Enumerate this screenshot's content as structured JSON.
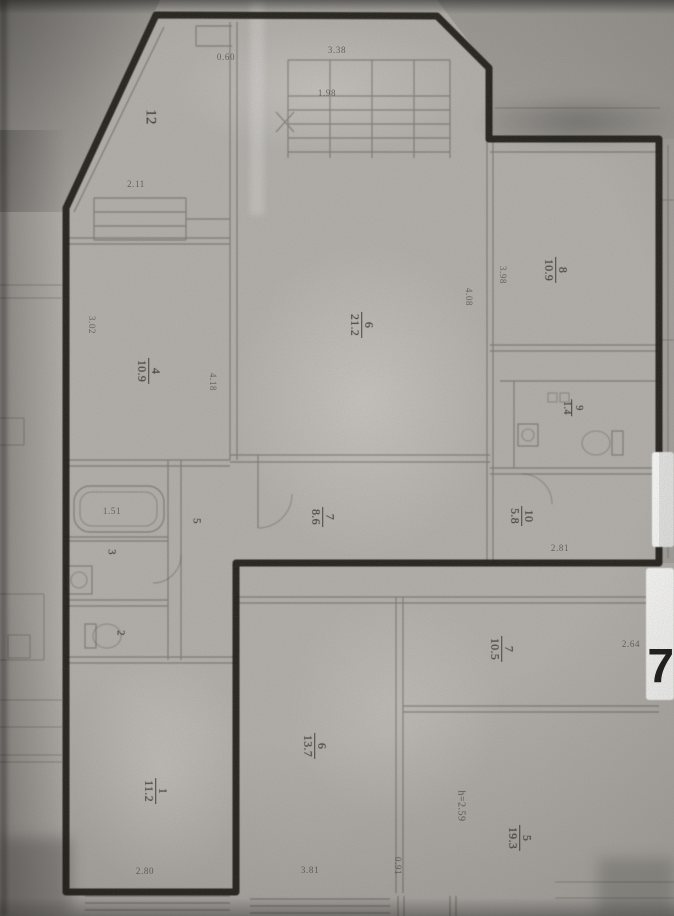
{
  "room_labels": [
    {
      "number": "12",
      "area": null,
      "x": 150,
      "y": 117,
      "size": 15
    },
    {
      "number": "4",
      "area": "10.9",
      "x": 149,
      "y": 371
    },
    {
      "number": "6",
      "area": "21.2",
      "x": 362,
      "y": 325
    },
    {
      "number": "8",
      "area": "10.9",
      "x": 556,
      "y": 270
    },
    {
      "number": "7",
      "area": "8.6",
      "x": 323,
      "y": 517
    },
    {
      "number": "10",
      "area": "5.8",
      "x": 522,
      "y": 516
    },
    {
      "number": "9",
      "area": "1.4",
      "x": 572,
      "y": 408,
      "size": 10
    },
    {
      "number": "3",
      "area": null,
      "x": 111,
      "y": 552,
      "size": 11
    },
    {
      "number": "2",
      "area": null,
      "x": 120,
      "y": 633,
      "size": 11
    },
    {
      "number": "5",
      "area": null,
      "x": 196,
      "y": 521,
      "size": 11
    },
    {
      "number": "1",
      "area": "11.2",
      "x": 156,
      "y": 791
    },
    {
      "number": "6",
      "area": "13.7",
      "x": 315,
      "y": 746
    },
    {
      "number": "7",
      "area": "10.5",
      "x": 502,
      "y": 649
    },
    {
      "number": "5",
      "area": "19.3",
      "x": 520,
      "y": 838
    }
  ],
  "dimensions": [
    {
      "text": "0.60",
      "x": 226,
      "y": 57,
      "rot": 0
    },
    {
      "text": "3.38",
      "x": 337,
      "y": 50,
      "rot": 0
    },
    {
      "text": "1.98",
      "x": 327,
      "y": 93,
      "rot": 0
    },
    {
      "text": "2.11",
      "x": 136,
      "y": 184,
      "rot": 0
    },
    {
      "text": "3.02",
      "x": 92,
      "y": 325,
      "rot": 90
    },
    {
      "text": "4.18",
      "x": 213,
      "y": 382,
      "rot": 90
    },
    {
      "text": "4.08",
      "x": 469,
      "y": 297,
      "rot": 90
    },
    {
      "text": "3.98",
      "x": 503,
      "y": 275,
      "rot": 90
    },
    {
      "text": "2.81",
      "x": 560,
      "y": 548,
      "rot": 0
    },
    {
      "text": "1.51",
      "x": 112,
      "y": 511,
      "rot": 0
    },
    {
      "text": "2.64",
      "x": 631,
      "y": 644,
      "rot": 0
    },
    {
      "text": "0.91",
      "x": 398,
      "y": 866,
      "rot": 90
    },
    {
      "text": "2.80",
      "x": 145,
      "y": 871,
      "rot": 0
    },
    {
      "text": "3.81",
      "x": 310,
      "y": 870,
      "rot": 0
    }
  ],
  "annotations": [
    {
      "kind": "note",
      "text": "h=2.59",
      "x": 461,
      "y": 806
    },
    {
      "kind": "marker",
      "text": "7",
      "x": 661,
      "y": 667,
      "size": 48
    }
  ]
}
